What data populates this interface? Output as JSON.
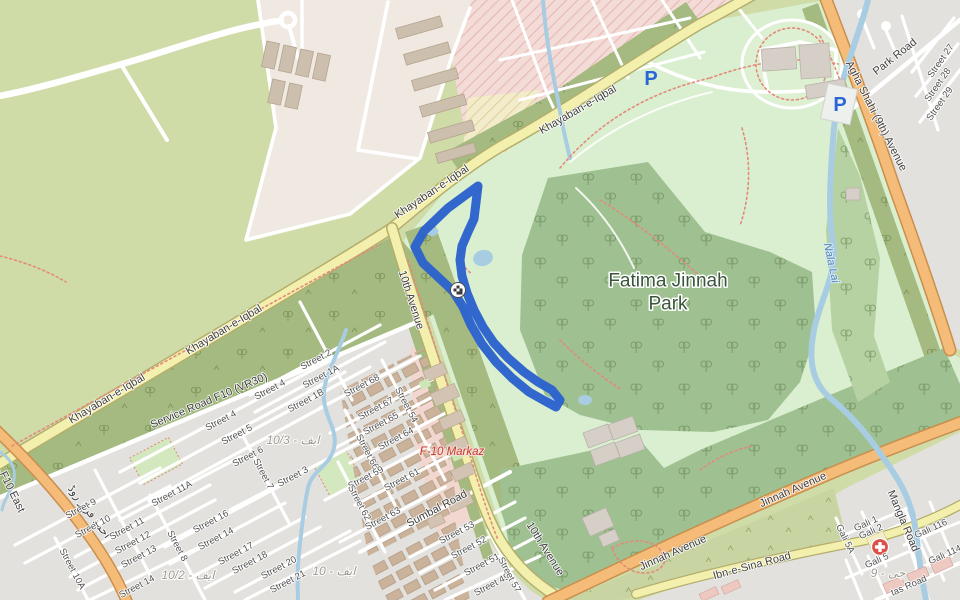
{
  "map": {
    "type": "street-map",
    "park_name": "Fatima Jinnah Park",
    "colors": {
      "park_light": "#d9efd0",
      "forest": "#9fc090",
      "forest_medium": "#b7d2a2",
      "road_band_olive": "#a4ba80",
      "olive_light": "#c8d4a2",
      "scrub": "#cfdca8",
      "residential": "#e3e1dd",
      "construction_pink": "#f3dcd8",
      "retail_pink": "#f1d7cf",
      "road_yellow": "#f3efad",
      "road_orange": "#f4bc78",
      "water": "#a8cde2",
      "route_blue": "#2b62cd",
      "parking_blue": "#2a66d6",
      "hospital_red": "#d9534a"
    },
    "route": {
      "d": "M478 186 L448 208 L424 231 L415 247 L423 263 L438 277 L453 291 L463 307 L471 325 L482 344 L496 362 L512 378 L529 392 L545 401 L556 407 L560 400 L552 390 L538 382 L524 372 L508 358 L494 343 L483 327 L474 310 L467 293 L462 276 L460 260 L462 246 L468 232 L474 219 Z",
      "color": "#2b62cd"
    },
    "poi": {
      "parking_symbol": "P",
      "parking_positions": [
        {
          "x": 651,
          "y": 79
        },
        {
          "x": 840,
          "y": 105
        }
      ],
      "hospital": {
        "x": 880,
        "y": 547
      },
      "route_marker": {
        "x": 458,
        "y": 290
      }
    },
    "labels": {
      "place": [
        {
          "t": "Fatima Jinnah",
          "x": 668,
          "y": 281,
          "r": 0
        },
        {
          "t": "Park",
          "x": 668,
          "y": 304,
          "r": 0
        }
      ],
      "road": [
        {
          "t": "Khayaban-e-Iqbal",
          "x": 578,
          "y": 110,
          "r": -30
        },
        {
          "t": "Khayaban-e-Iqbal",
          "x": 432,
          "y": 192,
          "r": -34
        },
        {
          "t": "Khayaban-e-Iqbal",
          "x": 224,
          "y": 330,
          "r": -31
        },
        {
          "t": "Khayaban-e-Iqbal",
          "x": 107,
          "y": 399,
          "r": -31
        },
        {
          "t": "10th Avenue",
          "x": 411,
          "y": 300,
          "r": 72
        },
        {
          "t": "10th Avenue",
          "x": 545,
          "y": 549,
          "r": 58
        },
        {
          "t": "Service Road F10 (VR30)",
          "x": 209,
          "y": 401,
          "r": -23,
          "s": 10
        },
        {
          "t": "Jinnah Avenue",
          "x": 793,
          "y": 490,
          "r": -24
        },
        {
          "t": "Jinnah Avenue",
          "x": 673,
          "y": 553,
          "r": -24
        },
        {
          "t": "Ibn-e-Sina Road",
          "x": 752,
          "y": 566,
          "r": -15
        },
        {
          "t": "Agha Shahi (9th) Avenue",
          "x": 876,
          "y": 116,
          "r": 63
        },
        {
          "t": "Park Road",
          "x": 895,
          "y": 57,
          "r": -38
        },
        {
          "t": "Mangla Road",
          "x": 903,
          "y": 521,
          "r": 67,
          "s": 10
        },
        {
          "t": "Sumbal Road",
          "x": 437,
          "y": 509,
          "r": -28,
          "s": 10
        },
        {
          "t": "احمد فراز روڈ",
          "x": 89,
          "y": 512,
          "r": 53,
          "s": 10
        },
        {
          "t": "F10 East",
          "x": 12,
          "y": 492,
          "r": 64,
          "s": 9
        }
      ],
      "street": [
        {
          "t": "Street 2",
          "x": 316,
          "y": 360,
          "r": -28
        },
        {
          "t": "Street 1A",
          "x": 321,
          "y": 377,
          "r": -28
        },
        {
          "t": "Street 1B",
          "x": 306,
          "y": 401,
          "r": -28
        },
        {
          "t": "Street 4",
          "x": 270,
          "y": 390,
          "r": -28
        },
        {
          "t": "Street 4",
          "x": 221,
          "y": 421,
          "r": -28
        },
        {
          "t": "Street 5",
          "x": 237,
          "y": 435,
          "r": -28
        },
        {
          "t": "Street 6",
          "x": 248,
          "y": 457,
          "r": -28
        },
        {
          "t": "Street 7",
          "x": 263,
          "y": 474,
          "r": 62
        },
        {
          "t": "Street 3",
          "x": 293,
          "y": 477,
          "r": -28
        },
        {
          "t": "Street 9",
          "x": 81,
          "y": 509,
          "r": -28
        },
        {
          "t": "Street 10",
          "x": 93,
          "y": 527,
          "r": -28
        },
        {
          "t": "Street 10A",
          "x": 72,
          "y": 569,
          "r": 62
        },
        {
          "t": "Street 11",
          "x": 127,
          "y": 529,
          "r": -28
        },
        {
          "t": "Street 11A",
          "x": 172,
          "y": 494,
          "r": -28
        },
        {
          "t": "Street 12",
          "x": 133,
          "y": 543,
          "r": -28
        },
        {
          "t": "Street 13",
          "x": 139,
          "y": 557,
          "r": -28
        },
        {
          "t": "Street 14",
          "x": 137,
          "y": 587,
          "r": -28
        },
        {
          "t": "Street 8",
          "x": 177,
          "y": 546,
          "r": 62
        },
        {
          "t": "Street 16",
          "x": 211,
          "y": 522,
          "r": -28
        },
        {
          "t": "Street 14",
          "x": 216,
          "y": 539,
          "r": -28
        },
        {
          "t": "Street 17",
          "x": 236,
          "y": 554,
          "r": -28
        },
        {
          "t": "Street 18",
          "x": 250,
          "y": 563,
          "r": -28
        },
        {
          "t": "Street 20",
          "x": 279,
          "y": 568,
          "r": -28
        },
        {
          "t": "Street 21",
          "x": 288,
          "y": 582,
          "r": -28
        },
        {
          "t": "Street 68",
          "x": 362,
          "y": 386,
          "r": -28
        },
        {
          "t": "Street 67",
          "x": 376,
          "y": 409,
          "r": -28
        },
        {
          "t": "Street 65",
          "x": 381,
          "y": 424,
          "r": -28
        },
        {
          "t": "Street 64",
          "x": 396,
          "y": 439,
          "r": -28
        },
        {
          "t": "Street 54",
          "x": 406,
          "y": 405,
          "r": 62
        },
        {
          "t": "Street 66",
          "x": 367,
          "y": 452,
          "r": 62
        },
        {
          "t": "Street 59",
          "x": 366,
          "y": 478,
          "r": -28
        },
        {
          "t": "Street 61",
          "x": 402,
          "y": 480,
          "r": -28
        },
        {
          "t": "Street 62",
          "x": 359,
          "y": 503,
          "r": 62
        },
        {
          "t": "Street 63",
          "x": 383,
          "y": 519,
          "r": -28
        },
        {
          "t": "Street 53",
          "x": 457,
          "y": 533,
          "r": -28
        },
        {
          "t": "Street 52",
          "x": 469,
          "y": 548,
          "r": -28
        },
        {
          "t": "Street 51",
          "x": 482,
          "y": 565,
          "r": -28
        },
        {
          "t": "Street 49",
          "x": 492,
          "y": 585,
          "r": -28
        },
        {
          "t": "Street 57",
          "x": 509,
          "y": 575,
          "r": 62
        },
        {
          "t": "Gali 1",
          "x": 866,
          "y": 524,
          "r": -24
        },
        {
          "t": "Gali 2",
          "x": 871,
          "y": 532,
          "r": -24
        },
        {
          "t": "Gali 5A",
          "x": 845,
          "y": 539,
          "r": 64
        },
        {
          "t": "Gali 5",
          "x": 877,
          "y": 561,
          "r": -24
        },
        {
          "t": "Gali 116",
          "x": 931,
          "y": 529,
          "r": -24
        },
        {
          "t": "Gali 114",
          "x": 945,
          "y": 555,
          "r": -24
        },
        {
          "t": "tas Road",
          "x": 909,
          "y": 586,
          "r": -24
        },
        {
          "t": "Street 27",
          "x": 941,
          "y": 61,
          "r": -55
        },
        {
          "t": "Street 28",
          "x": 938,
          "y": 85,
          "r": -55
        },
        {
          "t": "Street 29",
          "x": 940,
          "y": 104,
          "r": -55
        }
      ],
      "water": [
        {
          "t": "Nala Lai",
          "x": 831,
          "y": 263,
          "r": 78
        }
      ],
      "area": [
        {
          "t": "10/3 - ایف",
          "x": 293,
          "y": 440,
          "r": 0
        },
        {
          "t": "10/2 - ایف",
          "x": 188,
          "y": 575,
          "r": 0
        },
        {
          "t": "10 - ایف",
          "x": 334,
          "y": 571,
          "r": 0,
          "s": 15
        },
        {
          "t": "جی - 9",
          "x": 888,
          "y": 573,
          "r": 0,
          "s": 14
        }
      ],
      "retail": [
        {
          "t": "F-10 Markaz",
          "x": 452,
          "y": 452,
          "r": 0
        }
      ]
    }
  }
}
